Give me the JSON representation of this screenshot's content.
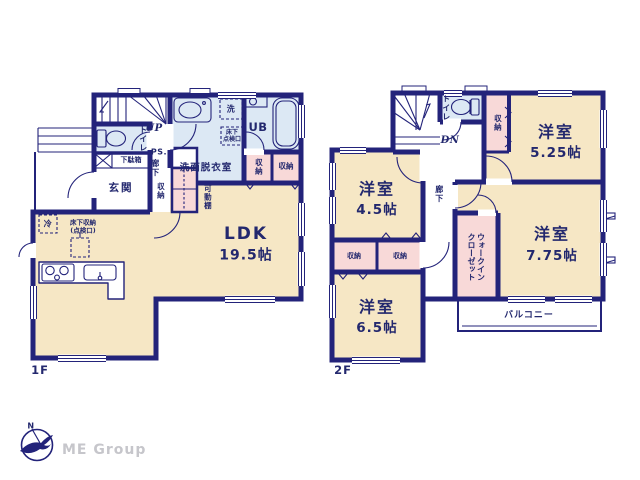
{
  "colors": {
    "wall": "#23237a",
    "text": "#23286e",
    "room_cream": "#f6e7c5",
    "room_blue": "#dce8f4",
    "room_pink": "#f8d9d8",
    "logo_gray": "#c6c6cb"
  },
  "floor1": {
    "floor_label": "1F",
    "stairs_label": "UP",
    "toilet": "トイレ",
    "shoe_box": "下駄箱",
    "entrance": "玄関",
    "pipe_shaft": "PS.",
    "hallway": "廊下",
    "hall_storage": "収納",
    "movable_shelf": "可動棚",
    "washroom": "洗面脱衣室",
    "washer": "洗",
    "underfloor_check": "床下\n点検口",
    "unit_bath": "UB",
    "storage_a": "収納",
    "storage_b": "収納",
    "fridge": "冷",
    "underfloor_storage": "床下収納\n(点検口)",
    "ldk": {
      "name": "LDK",
      "size": "19.5帖"
    }
  },
  "floor2": {
    "floor_label": "2F",
    "stairs_label": "DN",
    "toilet": "トイレ",
    "hall_storage": "収納",
    "room_525": {
      "name": "洋室",
      "size": "5.25帖"
    },
    "room_45": {
      "name": "洋室",
      "size": "4.5帖"
    },
    "hallway": "廊下",
    "storage_a": "収納",
    "storage_b": "収納",
    "room_65": {
      "name": "洋室",
      "size": "6.5帖"
    },
    "walk_in_closet": "ウォークイン\nクローゼット",
    "room_775": {
      "name": "洋室",
      "size": "7.75帖"
    },
    "balcony": "バルコニー"
  },
  "logo": {
    "text": "ME Group",
    "compass_letter": "N"
  }
}
